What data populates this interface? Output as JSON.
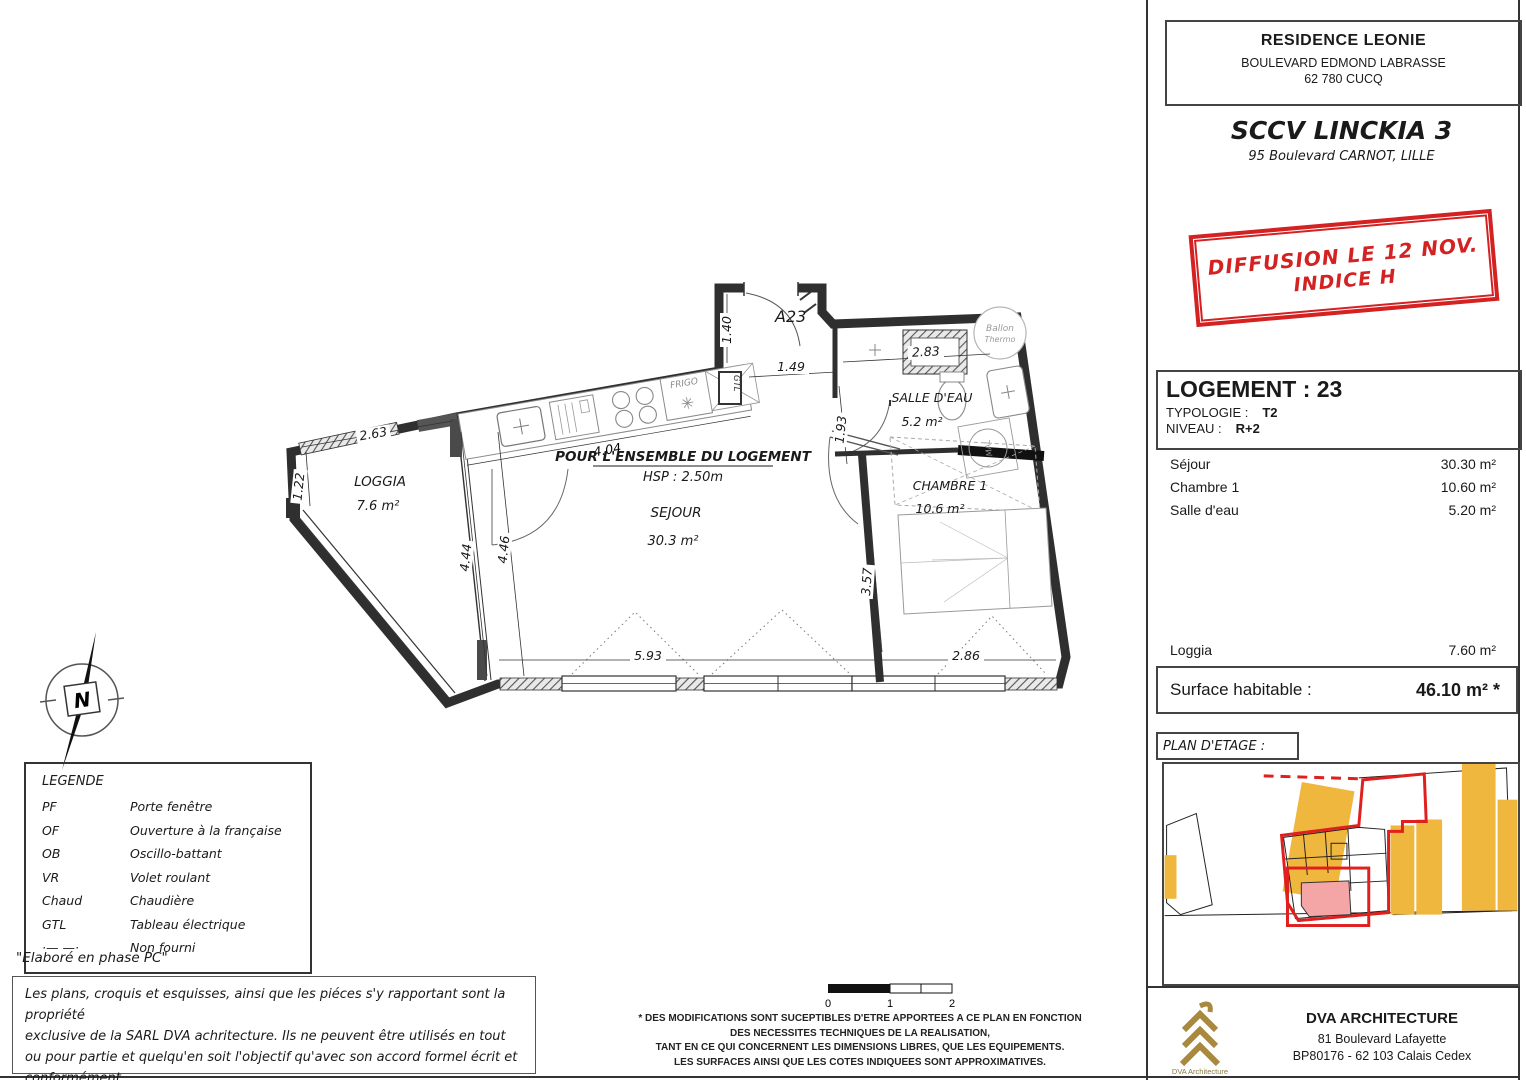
{
  "header": {
    "residence": "RESIDENCE LEONIE",
    "address1": "BOULEVARD EDMOND LABRASSE",
    "address2": "62 780 CUCQ",
    "company": "SCCV LINCKIA 3",
    "company_address": "95 Boulevard CARNOT, LILLE"
  },
  "stamp": {
    "line1": "DIFFUSION LE 12 NOV.",
    "line2": "INDICE H",
    "color": "#d42121"
  },
  "unit": {
    "title": "LOGEMENT : 23",
    "typologie_label": "TYPOLOGIE :",
    "typologie": "T2",
    "niveau_label": "NIVEAU :",
    "niveau": "R+2"
  },
  "surfaces": {
    "rows": [
      {
        "label": "Séjour",
        "value": "30.30 m²"
      },
      {
        "label": "Chambre 1",
        "value": "10.60 m²"
      },
      {
        "label": "Salle d'eau",
        "value": "5.20 m²"
      }
    ],
    "loggia": {
      "label": "Loggia",
      "value": "7.60 m²"
    },
    "habitable_label": "Surface habitable :",
    "habitable_value": "46.10 m² *"
  },
  "plan_etage_label": "PLAN D'ETAGE :",
  "architect": {
    "name": "DVA ARCHITECTURE",
    "address1": "81 Boulevard Lafayette",
    "address2": "BP80176 - 62 103 Calais Cedex",
    "logo_caption": "DVA Architecture",
    "logo_color": "#a8893d"
  },
  "legend": {
    "title": "LEGENDE",
    "items": [
      [
        "PF",
        "Porte fenêtre"
      ],
      [
        "OF",
        "Ouverture à la française"
      ],
      [
        "OB",
        "Oscillo-battant"
      ],
      [
        "VR",
        "Volet roulant"
      ],
      [
        "Chaud",
        "Chaudière"
      ],
      [
        "GTL",
        "Tableau électrique"
      ],
      [
        "·— —·",
        "Non fourni"
      ]
    ]
  },
  "notes": {
    "phase": "\"Elaboré en phase PC\"",
    "copyright": [
      "Les plans, croquis et esquisses, ainsi que les piéces s'y rapportant sont la propriété",
      "exclusive de la SARL DVA achritecture. Ils ne peuvent être utilisés en tout",
      "ou pour partie et quelqu'en soit l'objectif qu'avec son accord formel écrit et conformément",
      "à l'article 111-1 du code de la propriété intellectuelle."
    ],
    "disclaimer": [
      "* DES MODIFICATIONS SONT SUCEPTIBLES D'ETRE APPORTEES A CE PLAN EN FONCTION",
      "DES NECESSITES TECHNIQUES DE LA REALISATION,",
      "TANT EN CE QUI CONCERNENT LES DIMENSIONS LIBRES, QUE LES EQUIPEMENTS.",
      "LES SURFACES AINSI QUE LES COTES INDIQUEES SONT APPROXIMATIVES."
    ]
  },
  "scale": {
    "labels": [
      "0",
      "1",
      "2"
    ]
  },
  "plan": {
    "apartment_code": "A23",
    "ensemble_note": "POUR L'ENSEMBLE DU LOGEMENT",
    "hsp": "HSP : 2.50m",
    "north": "N",
    "rooms": {
      "loggia": {
        "name": "LOGGIA",
        "area": "7.6 m²"
      },
      "sejour": {
        "name": "SEJOUR",
        "area": "30.3 m²"
      },
      "salle": {
        "name": "SALLE D'EAU",
        "area": "5.2 m²"
      },
      "chambre": {
        "name": "CHAMBRE 1",
        "area": "10.6 m²"
      }
    },
    "labels": {
      "frigo": "FRIGO",
      "gtl": "GTL",
      "ballon1": "Ballon",
      "ballon2": "Thermo",
      "mal": "MAL"
    },
    "dims": {
      "loggia_w": "2.63",
      "loggia_h": "1.22",
      "partition_left": "4.44",
      "partition_right": "4.46",
      "kitchen": "4.04",
      "corridor": "1.40",
      "hall_w": "1.49",
      "hall_h": "1.93",
      "shower": "2.83",
      "sejour_w": "5.93",
      "chambre_w": "2.86",
      "chambre_h": "3.57"
    }
  },
  "site_plan_colors": {
    "building": "#f0b73e",
    "outline": "#e01f1f",
    "highlight": "#f4a6a6"
  }
}
